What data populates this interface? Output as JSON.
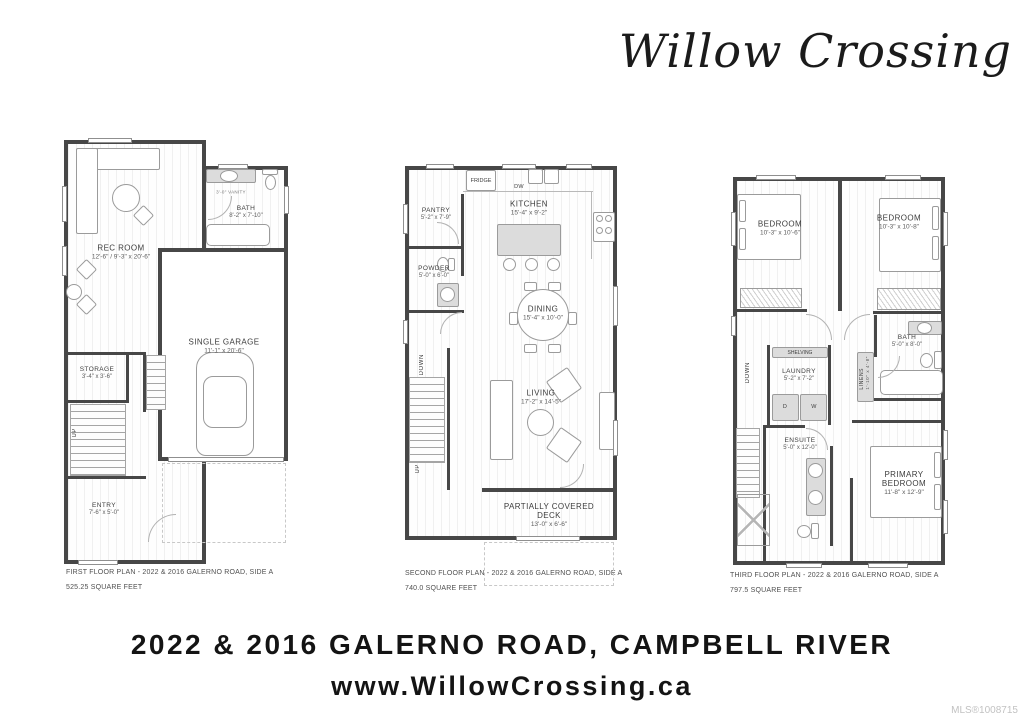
{
  "logo": {
    "text": "Willow Crossing"
  },
  "footer": {
    "address": "2022 & 2016 GALERNO ROAD, CAMPBELL RIVER",
    "website": "www.WillowCrossing.ca",
    "mls": "MLS®1008715"
  },
  "plan1": {
    "caption": "FIRST FLOOR PLAN - 2022 & 2016 GALERNO ROAD, SIDE A",
    "area": "525.25 SQUARE FEET",
    "rooms": {
      "rec": {
        "name": "REC ROOM",
        "dims": "12'-6\" / 9'-3\" x 20'-6\""
      },
      "bath": {
        "name": "BATH",
        "dims": "8'-2\" x 7'-10\""
      },
      "garage": {
        "name": "SINGLE GARAGE",
        "dims": "11'-1\" x 20'-6\""
      },
      "storage": {
        "name": "STORAGE",
        "dims": "3'-4\" x 3'-6\""
      },
      "entry": {
        "name": "ENTRY",
        "dims": "7'-6\" x 5'-0\""
      }
    },
    "labels": {
      "up": "UP",
      "vanity": "3'-0\" VANITY"
    }
  },
  "plan2": {
    "caption": "SECOND FLOOR PLAN - 2022 & 2016 GALERNO ROAD, SIDE A",
    "area": "740.0 SQUARE FEET",
    "rooms": {
      "pantry": {
        "name": "PANTRY",
        "dims": "5'-2\" x 7'-9\""
      },
      "kitchen": {
        "name": "KITCHEN",
        "dims": "15'-4\" x 9'-2\""
      },
      "powder": {
        "name": "POWDER",
        "dims": "5'-0\" x 6'-0\""
      },
      "dining": {
        "name": "DINING",
        "dims": "15'-4\" x 10'-0\""
      },
      "living": {
        "name": "LIVING",
        "dims": "17'-2\" x 14'-5\""
      },
      "deck": {
        "name": "PARTIALLY COVERED DECK",
        "dims": "13'-0\" x 6'-6\""
      }
    },
    "labels": {
      "fridge": "FRIDGE",
      "dw": "DW",
      "down": "DOWN",
      "up": "UP"
    }
  },
  "plan3": {
    "caption": "THIRD FLOOR PLAN - 2022 & 2016 GALERNO ROAD, SIDE A",
    "area": "797.5 SQUARE FEET",
    "rooms": {
      "bedroom_left": {
        "name": "BEDROOM",
        "dims": "10'-3\" x 10'-6\""
      },
      "bedroom_right": {
        "name": "BEDROOM",
        "dims": "10'-3\" x 10'-8\""
      },
      "bath": {
        "name": "BATH",
        "dims": "5'-0\" x 8'-0\""
      },
      "laundry": {
        "name": "LAUNDRY",
        "dims": "5'-2\" x 7'-2\""
      },
      "linens": {
        "name": "LINENS",
        "dims": "1'-10\" x 4'-8\""
      },
      "ensuite": {
        "name": "ENSUITE",
        "dims": "5'-0\" x 12'-0\""
      },
      "primary": {
        "name": "PRIMARY BEDROOM",
        "dims": "11'-8\" x 12'-9\""
      }
    },
    "labels": {
      "shelving": "SHELVING",
      "d": "D",
      "w": "W",
      "down": "DOWN"
    }
  }
}
